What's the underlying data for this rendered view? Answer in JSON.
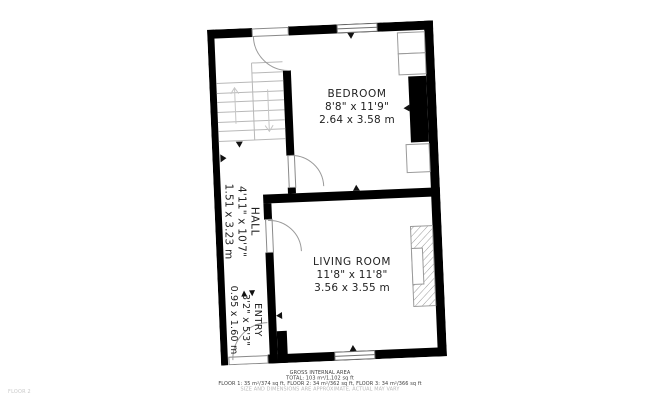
{
  "floor_tag": "FLOOR 2",
  "rooms": {
    "bedroom": {
      "name": "BEDROOM",
      "imperial": "8'8\" x 11'9\"",
      "metric": "2.64 x 3.58 m"
    },
    "living": {
      "name": "LIVING ROOM",
      "imperial": "11'8\" x 11'8\"",
      "metric": "3.56 x 3.55 m"
    },
    "hall": {
      "name": "HALL",
      "imperial": "4'11\" x 10'7\"",
      "metric": "1.51 x 3.23 m"
    },
    "entry": {
      "name": "ENTRY",
      "imperial": "3'2\" x 5'3\"",
      "metric": "0.95 x 1.60 m"
    }
  },
  "caption": {
    "title": "GROSS INTERNAL AREA",
    "total": "TOTAL: 103 m²/1,102 sq ft",
    "floors": "FLOOR 1: 35 m²/374 sq ft, FLOOR 2: 34 m²/362 sq ft, FLOOR 3: 34 m²/366 sq ft",
    "disclaimer": "SIZE AND DIMENSIONS ARE APPROXIMATE, ACTUAL MAY VARY"
  },
  "colors": {
    "wall": "#000000",
    "door_line": "#9a9a9a",
    "stair_line": "#b8b8b8",
    "window_line": "#6f6f6f",
    "text": "#1f1f1f",
    "caption_text": "#3d3d3d",
    "caption_muted": "#b9b9b9"
  }
}
